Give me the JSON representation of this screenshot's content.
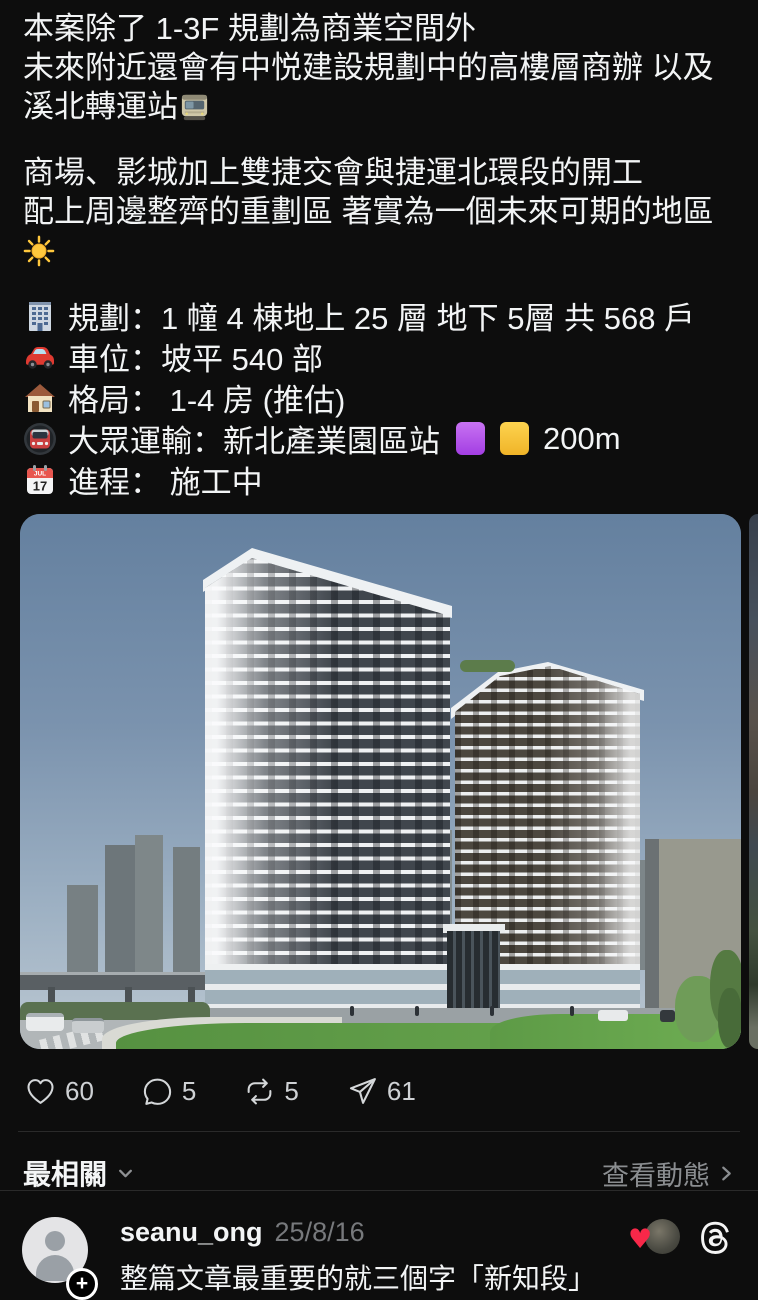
{
  "post": {
    "p1_l1": "本案除了 1-3F 規劃為商業空間外",
    "p1_l2": "未來附近還會有中悦建設規劃中的高樓層商辦 以及溪北轉運站",
    "p2_l1": "商場、影城加上雙捷交會與捷運北環段的開工",
    "p2_l2": "配上周邊整齊的重劃區 著實為一個未來可期的地區",
    "specs": [
      {
        "icon": "office-building-emoji",
        "text": "規劃：1 幢 4 棟地上 25 層 地下 5層 共 568 戶"
      },
      {
        "icon": "red-car-emoji",
        "text": "車位：坡平 540 部"
      },
      {
        "icon": "house-emoji",
        "text": "格局： 1-4 房 (推估)"
      },
      {
        "icon": "metro-emoji",
        "text": "大眾運輸：新北產業園區站",
        "suffix": "200m"
      },
      {
        "icon": "calendar-emoji",
        "text": "進程： 施工中",
        "calendar_day": "17"
      }
    ]
  },
  "engagement": {
    "likes": "60",
    "replies": "5",
    "reposts": "5",
    "shares": "61"
  },
  "feed_controls": {
    "sort_label": "最相關",
    "activity_link": "查看動態"
  },
  "comment": {
    "username": "seanu_ong",
    "date": "25/8/16",
    "text": "整篇文章最重要的就三個字「新知段」"
  },
  "colors": {
    "background": "#0d0d0d",
    "purple_square": "#b14cf0",
    "yellow_square": "#f7c325",
    "heart_red": "#f82849",
    "secondary_text": "#8a8d90"
  }
}
